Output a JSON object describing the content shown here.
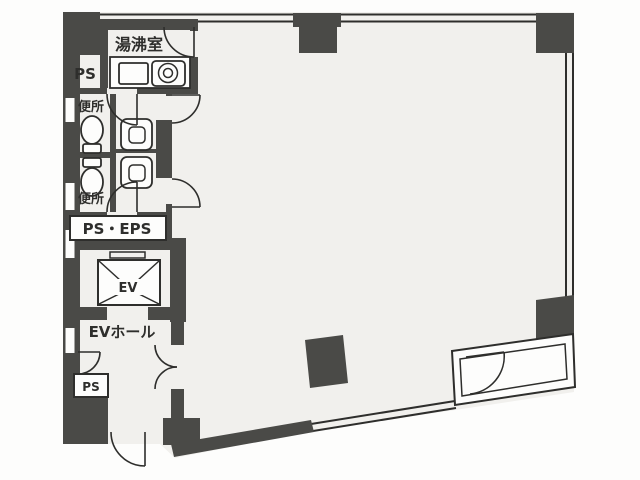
{
  "floorplan": {
    "type": "building-floor-plan",
    "rooms": {
      "kitchenette": {
        "label": "湯沸室"
      },
      "pipe_shaft_top": {
        "label": "PS"
      },
      "toilet_upper": {
        "label": "便所"
      },
      "toilet_lower": {
        "label": "便所"
      },
      "pipe_shaft_eps": {
        "label": "PS・EPS"
      },
      "elevator": {
        "label": "EV"
      },
      "elevator_hall": {
        "label": "EVホール"
      },
      "pipe_shaft_bottom": {
        "label": "PS"
      }
    },
    "fixtures": {
      "sink": "sink-basin",
      "stove": "single-burner-stove",
      "toilets": 2,
      "wash_basins": 2,
      "elevator_car": "elevator-car-x-symbol"
    },
    "colors": {
      "wall": "#4a4a47",
      "line": "#2e2e2c",
      "floor": "#f1f0ed",
      "paper": "#fdfdfc"
    }
  }
}
